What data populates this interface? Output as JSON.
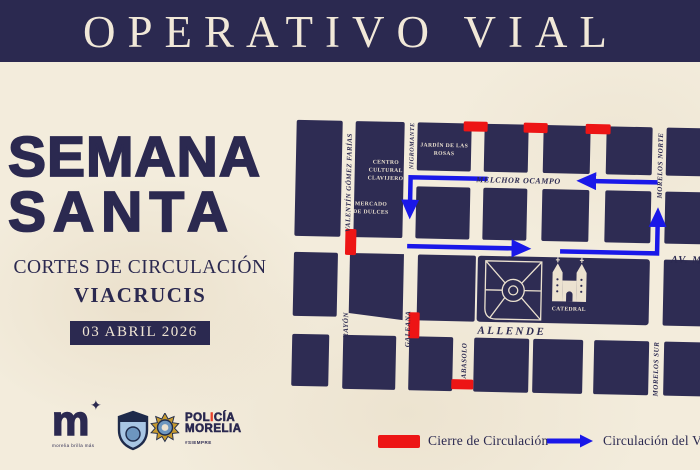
{
  "header": {
    "title": "OPERATIVO VIAL"
  },
  "left_panel": {
    "title_line1": "SEMANA",
    "title_line2": "SANTA",
    "subtitle": "CORTES DE CIRCULACIÓN",
    "event": "VIACRUCIS",
    "date_badge": "03 ABRIL 2026"
  },
  "map": {
    "streets": {
      "valentin_gomez_farias": "VALENTÍN GÓMEZ FARÍAS",
      "nigromante": "NIGROMANTE",
      "rayon": "RAYÓN",
      "galeana": "GALEANA",
      "abasolo": "ABASOLO",
      "morelos_norte": "MORELOS NORTE",
      "morelos_sur": "MORELOS SUR",
      "melchor_ocampo": "MELCHOR OCAMPO",
      "av_madero": "AV. MADERO",
      "allende": "ALLENDE"
    },
    "places": {
      "centro_cultural": [
        "CENTRO",
        "CULTURAL",
        "CLAVIJERO"
      ],
      "jardin": [
        "JARDÍN DE LAS",
        "ROSAS"
      ],
      "mercado": [
        "MERCADO",
        "DE DULCES"
      ],
      "catedral": "CATEDRAL"
    }
  },
  "legend": {
    "closure": "Cierre de Circulación",
    "route": "Circulación del Viacrucis"
  },
  "footer": {
    "city_logo_letter": "m",
    "city_tagline": "morelia brilla más",
    "police_name_p1": "POL",
    "police_accent": "I",
    "police_name_p2": "CÍA",
    "police_name_line2": "MORELIA",
    "police_hashtag": "#SIEMPRE"
  },
  "colors": {
    "navy": "#2b2950",
    "block_navy": "#2e2c53",
    "background_cream": "#f3ecdc",
    "label_cream": "#ece2d0",
    "closure_red": "#ed1515",
    "route_blue": "#1a18e8"
  }
}
